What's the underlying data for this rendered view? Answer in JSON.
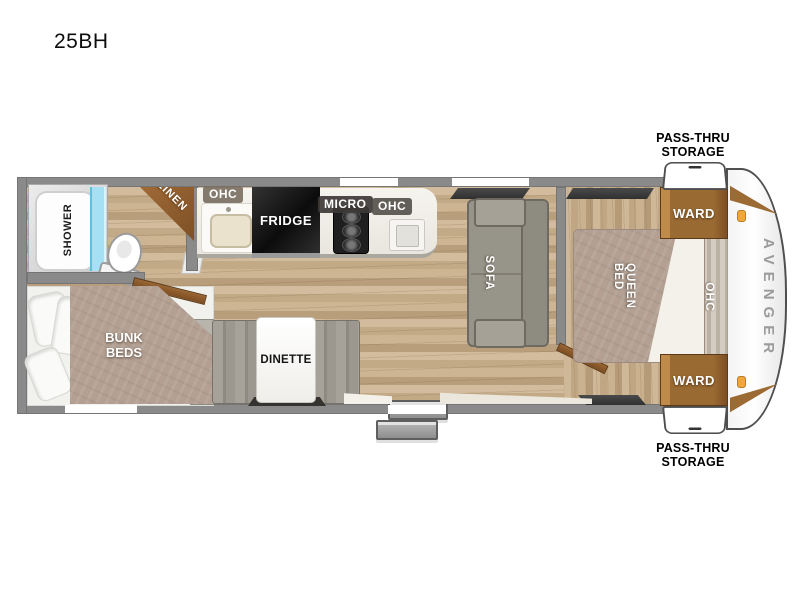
{
  "header": {
    "model": "25BH"
  },
  "floorplan": {
    "brand": "AVENGER",
    "rooms": {
      "shower": "SHOWER",
      "linen": "LINEN",
      "bunk_beds_line1": "BUNK",
      "bunk_beds_line2": "BEDS",
      "dinette": "DINETTE",
      "sofa": "SOFA",
      "queen_bed": "QUEEN BED",
      "ward_top": "WARD",
      "ward_bottom": "WARD",
      "ohc_kitchen_left": "OHC",
      "ohc_kitchen_right": "OHC",
      "ohc_bedroom": "OHC",
      "fridge": "FRIDGE",
      "micro": "MICRO"
    },
    "callouts": {
      "pass_thru_top_line1": "PASS-THRU",
      "pass_thru_top_line2": "STORAGE",
      "pass_thru_bottom_line1": "PASS-THRU",
      "pass_thru_bottom_line2": "STORAGE"
    },
    "colors": {
      "wall_gray": "#8a8a8a",
      "floor_wood": "#c9b18e",
      "cabinet_brown": "#9a6533",
      "shower_glass_blue": "#a6e0f5",
      "mattress_taupe": "#b3a093",
      "sofa_gray": "#97948a",
      "fridge_black": "#161616",
      "marker_light_orange": "#f0a63c",
      "brand_text_gray": "#9b9b9b"
    }
  }
}
